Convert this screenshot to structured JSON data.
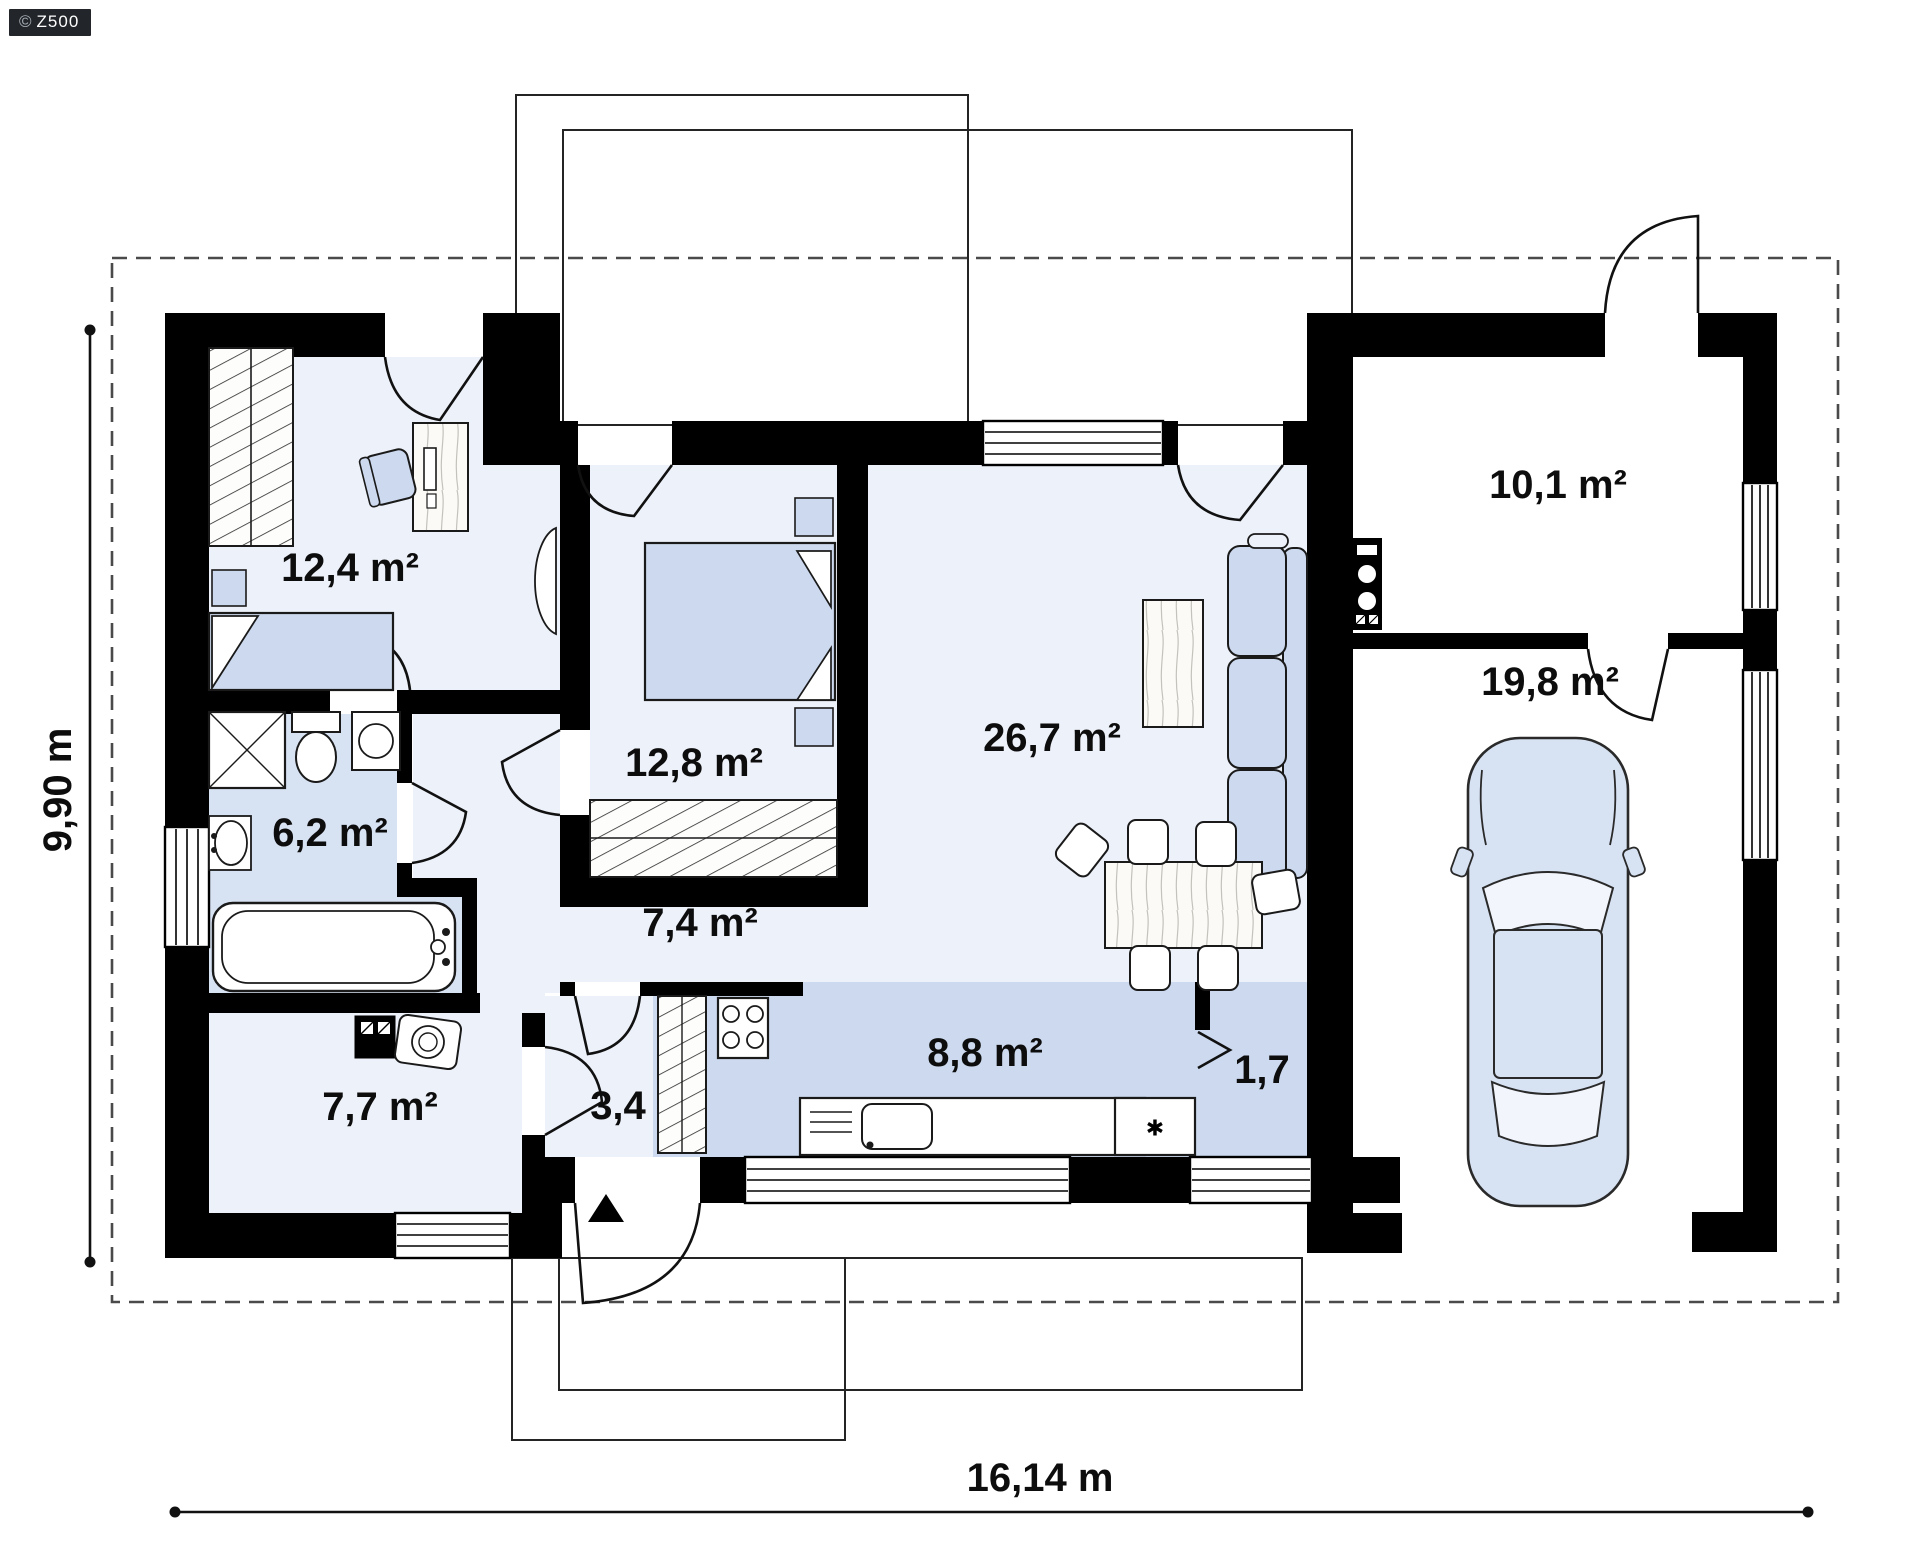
{
  "logo": {
    "copyright": "©",
    "brand": "Z500"
  },
  "floor_plan": {
    "rooms": [
      {
        "name": "cabinet",
        "area_label": "12,4 m²"
      },
      {
        "name": "bedroom",
        "area_label": "12,8 m²"
      },
      {
        "name": "living-room",
        "area_label": "26,7 m²"
      },
      {
        "name": "technical-room",
        "area_label": "10,1 m²"
      },
      {
        "name": "garage",
        "area_label": "19,8 m²"
      },
      {
        "name": "bathroom",
        "area_label": "6,2 m²"
      },
      {
        "name": "hallway",
        "area_label": "7,4 m²"
      },
      {
        "name": "utility-room",
        "area_label": "7,7 m²"
      },
      {
        "name": "entry-hall",
        "area_label": "3,4"
      },
      {
        "name": "kitchen",
        "area_label": "8,8 m²"
      },
      {
        "name": "pantry",
        "area_label": "1,7"
      }
    ],
    "dimensions": {
      "total_width": "16,14 m",
      "total_depth": "9,90 m"
    },
    "kitchen": {
      "appliance_star_symbol": "✱"
    },
    "colors": {
      "wall": "#000000",
      "room_light": "#edf1f9",
      "room_medium": "#d7e2f3",
      "furniture_blue": "#ccd9ee",
      "dashed_boundary": "#4a4a4a"
    }
  }
}
